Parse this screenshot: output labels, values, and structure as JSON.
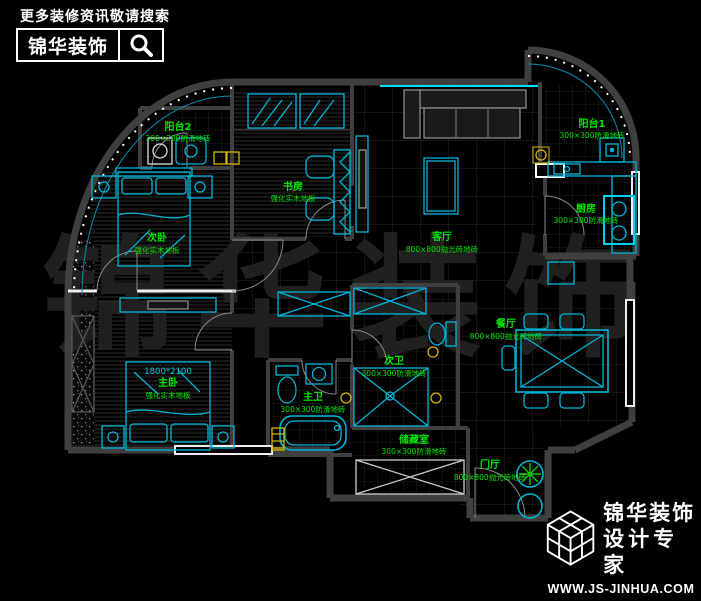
{
  "header": {
    "tagline": "更多装修资讯敬请搜索",
    "brand": "锦华装饰",
    "search_icon": "magnifier-icon"
  },
  "footer": {
    "logo_icon": "cube-lattice-logo",
    "brand": "锦华装饰",
    "subtitle": "设计专家",
    "website": "WWW.JS-JINHUA.COM"
  },
  "watermark": "锦华装饰",
  "colors": {
    "background": "#000000",
    "wall_gray": "#3f3f3f",
    "furniture_cyan": "#00b4d8",
    "accent_cyan": "#00e0ff",
    "label_green": "#00e600",
    "accent_yellow": "#d8b400",
    "window_white": "#eeeeee",
    "watermark_gray": "#202020"
  },
  "floorplan": {
    "bed_size": "1800*2100",
    "rooms": [
      {
        "name": "阳台2",
        "material": "300×300防滑地砖"
      },
      {
        "name": "书房",
        "material": "强化实木地板"
      },
      {
        "name": "次卧",
        "material": "强化实木地板"
      },
      {
        "name": "客厅",
        "material": "800×800抛光砖地砖"
      },
      {
        "name": "阳台1",
        "material": "300×300防滑地砖"
      },
      {
        "name": "厨房",
        "material": "300×300防滑地砖"
      },
      {
        "name": "餐厅",
        "material": "800×800抛光砖地砖"
      },
      {
        "name": "次卫",
        "material": "300×300防滑地砖"
      },
      {
        "name": "主卫",
        "material": "300×300防滑地砖"
      },
      {
        "name": "主卧",
        "material": "强化实木地板"
      },
      {
        "name": "储藏室",
        "material": "300×300防滑地砖"
      },
      {
        "name": "门厅",
        "material": "800×800抛光砖地砖"
      }
    ]
  }
}
